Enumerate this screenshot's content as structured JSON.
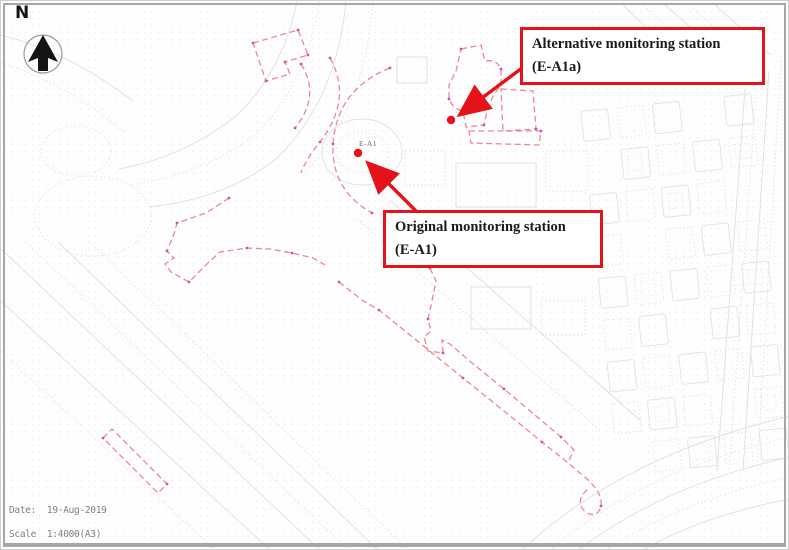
{
  "map": {
    "north_label": "N",
    "station_original_map_label": "E-A1",
    "callouts": {
      "alternative": {
        "line1": "Alternative monitoring station",
        "line2": "(E-A1a)"
      },
      "original": {
        "line1": "Original monitoring station",
        "line2": "(E-A1)"
      }
    },
    "footer": {
      "date_line": "Date:  19-Aug-2019",
      "scale_line": "Scale  1:4000(A3)"
    },
    "colors": {
      "annotation_red": "#e51219",
      "boundary_pink": "#ec8796",
      "vertex_magenta": "#d050b8",
      "linework_gray": "#dfdfe3",
      "footer_text_gray": "#7f7f7f"
    }
  }
}
